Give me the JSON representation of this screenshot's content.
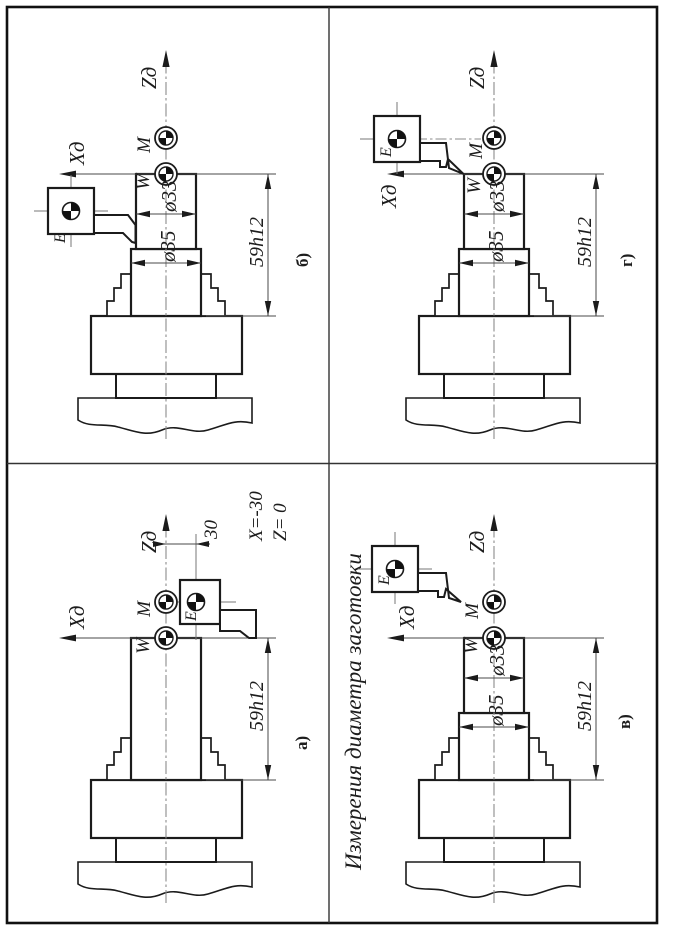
{
  "page": {
    "title": "Измерения диаметра заготовки"
  },
  "labels": {
    "axis_x": "Хд",
    "axis_z": "Zд",
    "point_m": "M",
    "point_w": "W",
    "point_e": "E"
  },
  "dims": {
    "length": "59h12",
    "d_small": "ø33",
    "d_large": "ø35",
    "offset": "30"
  },
  "coords": {
    "x": "X=-30",
    "z": "Z= 0"
  },
  "panels": {
    "a": {
      "label": "а)"
    },
    "b": {
      "label": "б)"
    },
    "v": {
      "label": "в)"
    },
    "g": {
      "label": "г)"
    }
  },
  "icons": {
    "datum_point": "machine-datum-symbol"
  },
  "colors": {
    "line": "#1b1b1b",
    "thin": "#4a4a4a",
    "center": "#8b8b8b",
    "paper": "#ffffff"
  }
}
